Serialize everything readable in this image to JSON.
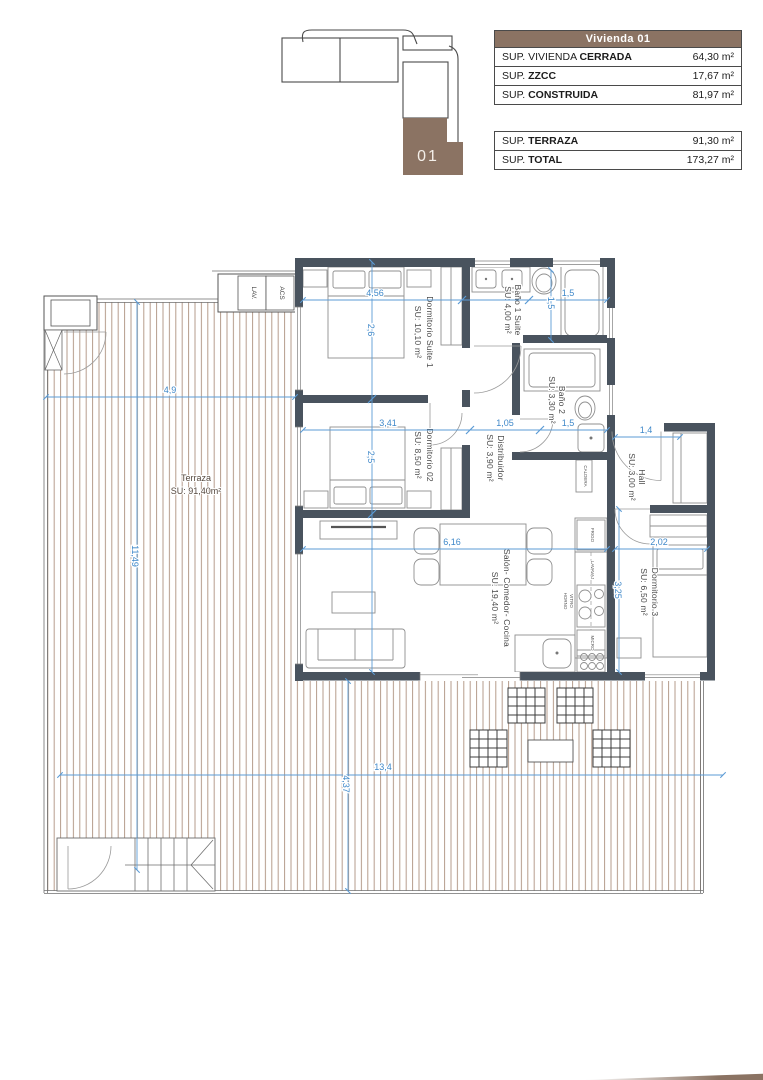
{
  "colors": {
    "accent_brown": "#8b7363",
    "wall_dark": "#49535e",
    "dimension_blue": "#4a90d2",
    "deck_stripe": "#b59c8c"
  },
  "key_plan": {
    "unit": "01"
  },
  "summary": {
    "title": "Vivienda 01",
    "rows_main": [
      {
        "prefix": "SUP. VIVIENDA ",
        "bold": "CERRADA",
        "value": "64,30 m²"
      },
      {
        "prefix": "SUP. ",
        "bold": "ZZCC",
        "value": "17,67 m²"
      },
      {
        "prefix": "SUP. ",
        "bold": "CONSTRUIDA",
        "value": "81,97 m²"
      }
    ],
    "rows_extra": [
      {
        "prefix": "SUP. ",
        "bold": "TERRAZA",
        "value": "91,30 m²"
      },
      {
        "prefix": "SUP. ",
        "bold": "TOTAL",
        "value": "173,27 m²"
      }
    ]
  },
  "rooms": {
    "terraza": {
      "name": "Terraza",
      "area": "SU: 91,40m²"
    },
    "suite1": {
      "name": "Dormitorio Suite 1",
      "area": "SU: 10,10 m²"
    },
    "bano1": {
      "name": "Baño 1 Suite",
      "area": "SU: 4,00 m²"
    },
    "bano2": {
      "name": "Baño 2",
      "area": "SU: 3,30 m²"
    },
    "dorm2": {
      "name": "Dormitorio 02",
      "area": "SU: 8,50 m²"
    },
    "distribuidor": {
      "name": "Distribuidor",
      "area": "SU: 3,90 m²"
    },
    "hall": {
      "name": "Hall",
      "area": "SU: 3,00 m²"
    },
    "salon": {
      "name": "Salón- Comedor- Cocina",
      "area": "SU: 19,40 m²"
    },
    "dorm3": {
      "name": "Dormitorio 3",
      "area": "SU: 6,50 m²"
    }
  },
  "fixtures": {
    "lav": "LAV.",
    "acs": "ACS",
    "frigo": "FRIGO",
    "lavavajillas": "LAVAVAJ",
    "vitro": "VITRO",
    "horno": "HORNO",
    "micro": "MICRO",
    "caldera": "CALDERA"
  },
  "dims": {
    "terrace_w": "4,9",
    "suite1_w": "4,56",
    "bath_len": "1,5",
    "bath_len_v": "1,5",
    "dorm2_w": "3,41",
    "distrib_w": "1,05",
    "bano2_w": "1,5",
    "hall_w": "1,4",
    "salon_w": "6,16",
    "dorm3_w": "2,02",
    "suite1_h": "2,6",
    "dorm2_h": "2,5",
    "dorm3_h": "3,25",
    "terrace_h": "11,49",
    "terrace_bottom_h": "4,37",
    "terrace_bottom_w": "13,4"
  }
}
